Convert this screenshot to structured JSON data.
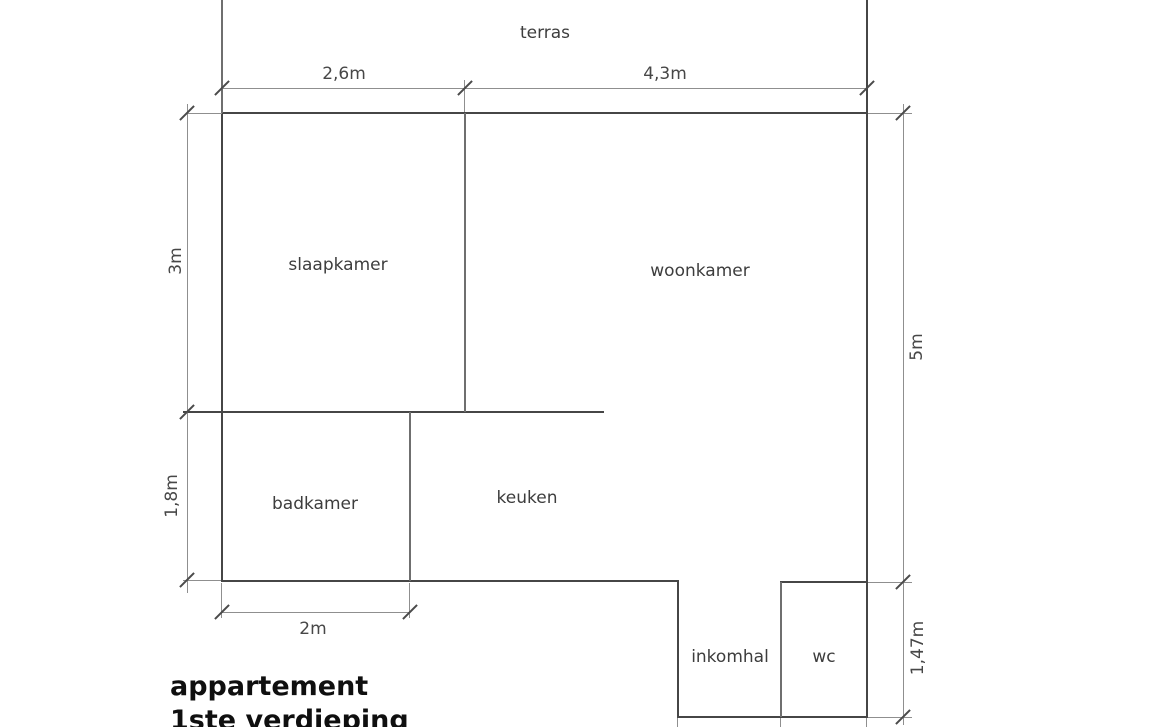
{
  "plan": {
    "title": {
      "line1": "appartement",
      "line2": "1ste verdieping"
    },
    "rooms": [
      {
        "id": "terras",
        "label": "terras"
      },
      {
        "id": "slaapkamer",
        "label": "slaapkamer"
      },
      {
        "id": "woonkamer",
        "label": "woonkamer"
      },
      {
        "id": "badkamer",
        "label": "badkamer"
      },
      {
        "id": "keuken",
        "label": "keuken"
      },
      {
        "id": "inkomhal",
        "label": "inkomhal"
      },
      {
        "id": "wc",
        "label": "wc"
      }
    ],
    "dimensions": [
      {
        "id": "top-left-width",
        "label": "2,6m",
        "edge": "top"
      },
      {
        "id": "top-right-width",
        "label": "4,3m",
        "edge": "top"
      },
      {
        "id": "slaapkamer-height",
        "label": "3m",
        "edge": "left"
      },
      {
        "id": "badkamer-height",
        "label": "1,8m",
        "edge": "left"
      },
      {
        "id": "apartment-height",
        "label": "5m",
        "edge": "right"
      },
      {
        "id": "hall-height",
        "label": "1,47m",
        "edge": "right"
      },
      {
        "id": "badkamer-width",
        "label": "2m",
        "edge": "bottom"
      }
    ],
    "colors": {
      "wall": "#464646",
      "partition": "#6f6f6f",
      "dimension_line": "#8f8f8f",
      "label_text": "#3d3d3d",
      "title_text": "#0f0f0f",
      "background": "#ffffff"
    }
  }
}
